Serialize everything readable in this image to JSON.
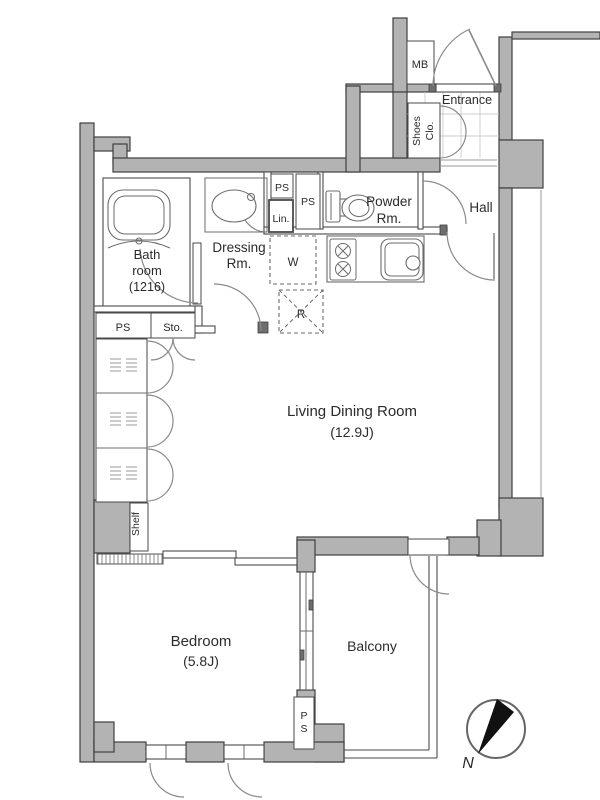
{
  "colors": {
    "wall_fill": "#b3b3b3",
    "wall_stroke": "#3f3f3f",
    "partition": "#4a4a4a",
    "jamb": "#6e6e6e",
    "arc": "#8a8a8a",
    "fixture": "#6b6b6b",
    "faint": "#9a9a9a",
    "tile": "#cccccc",
    "text": "#2b2b2b",
    "needle": "#111111"
  },
  "rooms": {
    "living": {
      "name": "Living Dining Room",
      "size": "(12.9J)"
    },
    "bedroom": {
      "name": "Bedroom",
      "size": "(5.8J)"
    },
    "balcony": {
      "name": "Balcony"
    },
    "bathroom": {
      "name_line1": "Bath",
      "name_line2": "room",
      "size": "(1216)"
    },
    "dressing": {
      "name_line1": "Dressing",
      "name_line2": "Rm."
    },
    "powder": {
      "name_line1": "Powder",
      "name_line2": "Rm."
    },
    "hall": {
      "name": "Hall"
    },
    "entrance": {
      "name": "Entrance"
    },
    "shoes_closet": {
      "name_line1": "Shoes",
      "name_line2": "Clo."
    }
  },
  "fixtures": {
    "meter_box": "MB",
    "pipe_space": "PS",
    "linen": "Lin.",
    "washer": "W",
    "refrigerator": "R",
    "storage": "Sto.",
    "shelf": "Shelf",
    "pipe_space_vertical": {
      "line1": "P",
      "line2": "S"
    }
  },
  "compass": {
    "north": "N"
  }
}
